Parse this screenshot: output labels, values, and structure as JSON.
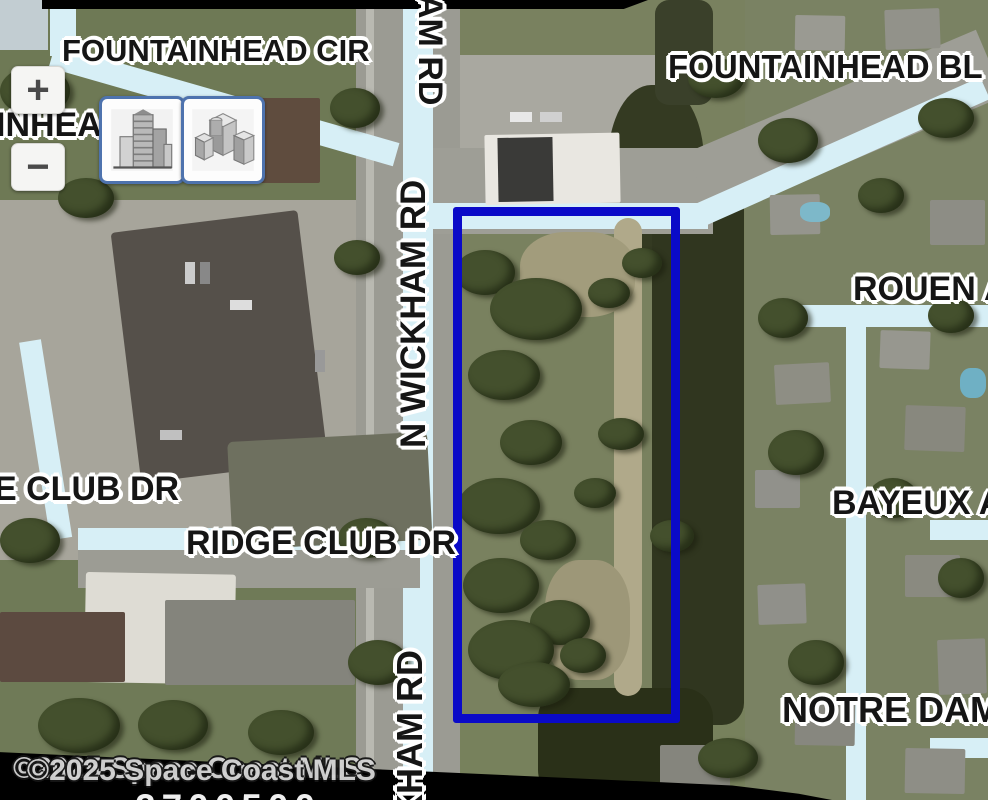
{
  "map": {
    "attribution": "©2025 Space Coast MLS",
    "bottom_fragment": "2700500",
    "labels": {
      "fountainhead_cir": "FOUNTAINHEAD CIR",
      "fountainhead_bl": "FOUNTAINHEAD BL",
      "fountainhead_partial": "INHEA",
      "wickham_tail_top": "AM RD",
      "wickham_mid": "N WICKHAM RD",
      "wickham_tail_bottom": "KHAM RD",
      "e_club_dr": "E CLUB DR",
      "ridge_club_dr": "RIDGE CLUB DR",
      "rouen": "ROUEN A",
      "bayeux": "BAYEUX A",
      "notre_dame": "NOTRE DAM"
    },
    "controls": {
      "zoom_in": "+",
      "zoom_out": "−"
    },
    "colors": {
      "parcel_outline": "#0a0ac8",
      "road_highlight": "#d7eff6"
    }
  }
}
